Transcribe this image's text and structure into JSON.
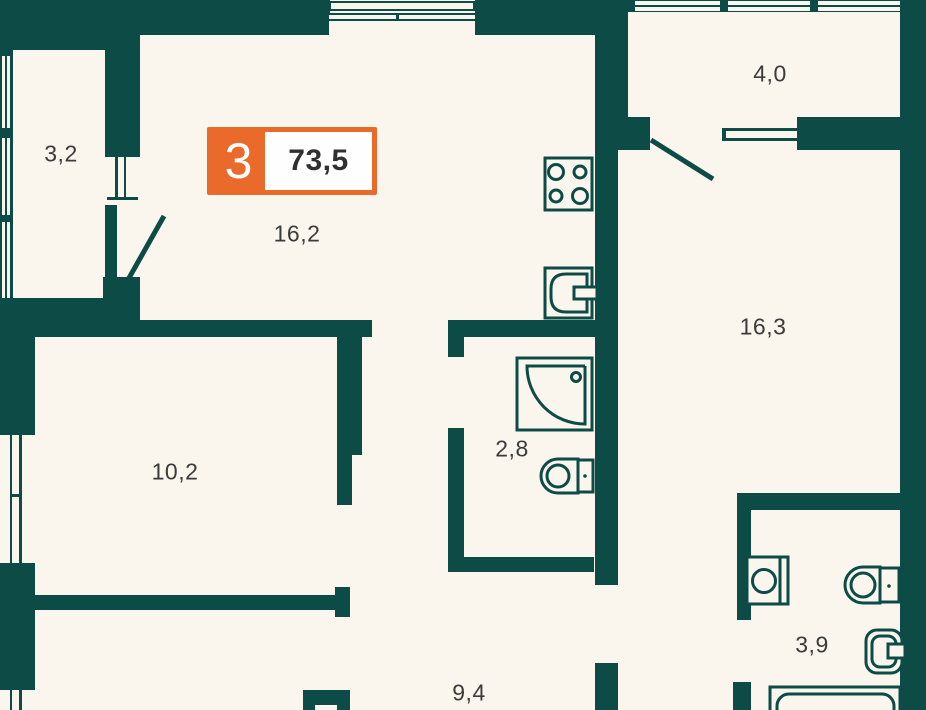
{
  "badge": {
    "rooms_count": "3",
    "total_area": "73,5"
  },
  "rooms": {
    "loggia_left": "3,2",
    "kitchen_living": "16,2",
    "loggia_top": "4,0",
    "room_right": "16,3",
    "room_left": "10,2",
    "bathroom_small": "2,8",
    "hallway": "9,4",
    "bathroom_large": "3,9"
  },
  "colors": {
    "wall": "#0d4b47",
    "background": "#faf5ed",
    "accent_orange": "#e96a2b",
    "area_text": "#3b3b3b",
    "badge_value_text": "#303030"
  }
}
